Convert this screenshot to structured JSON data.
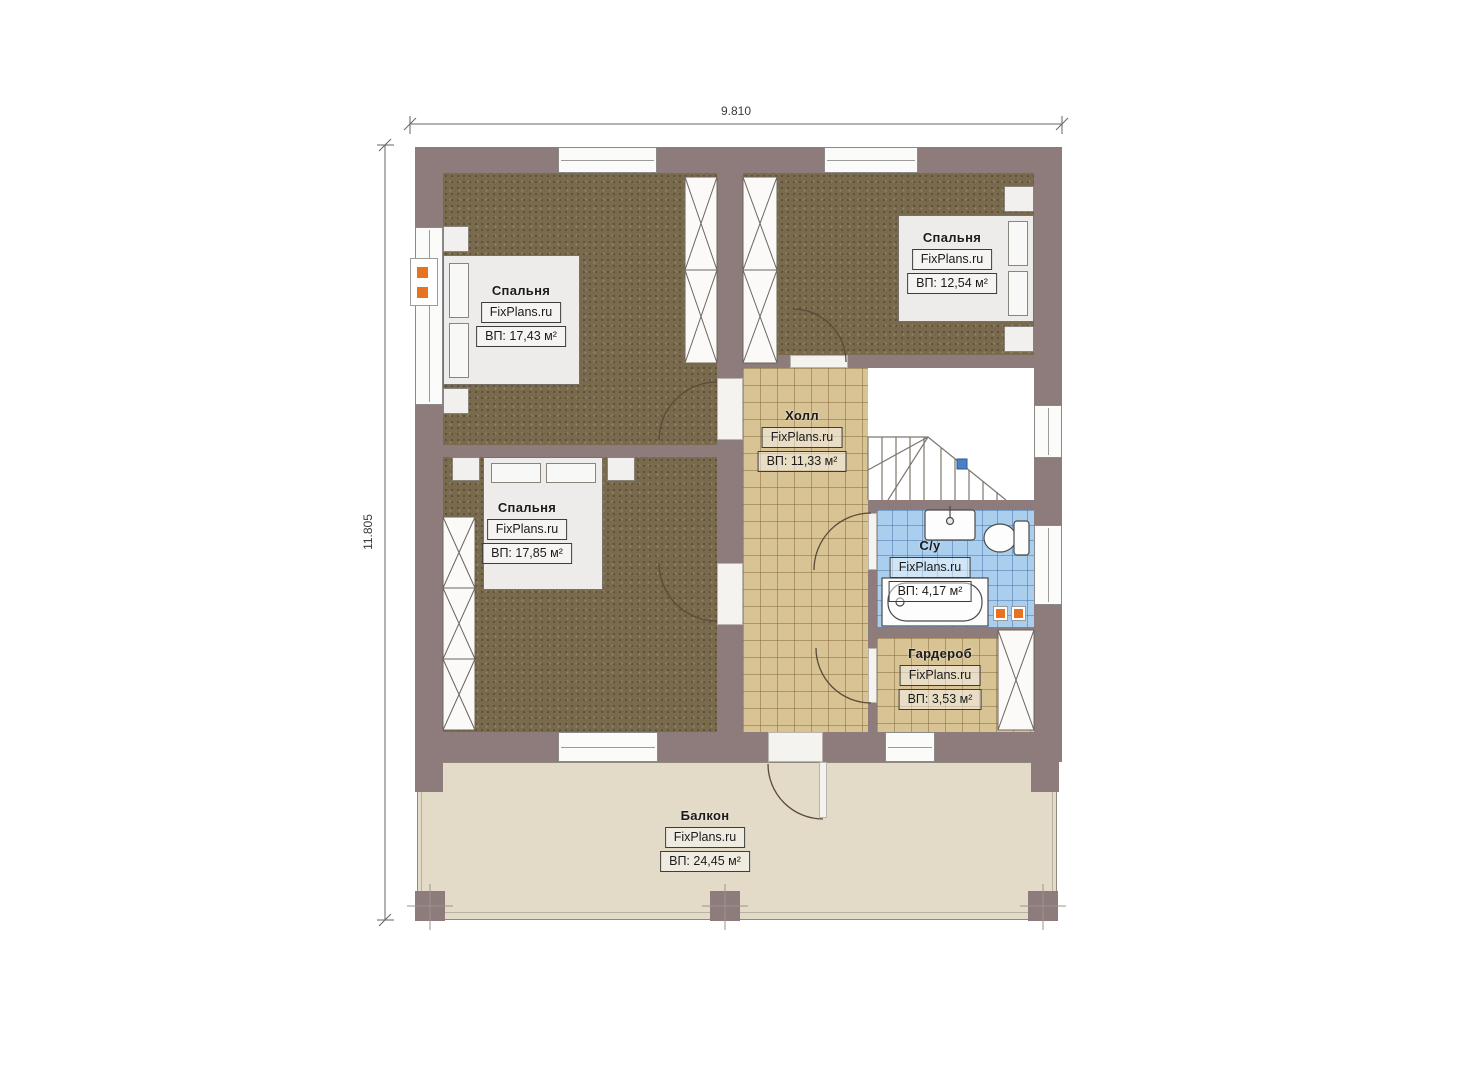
{
  "meta": {
    "drawing_type": "floor-plan",
    "language": "ru",
    "floor_description": "Second floor plan with three bedrooms, hall, bathroom, wardrobe and balcony"
  },
  "dimensions": {
    "overall_width": "9.810",
    "overall_height": "11.805"
  },
  "brand": "FixPlans.ru",
  "rooms": [
    {
      "key": "bedroom-top-left",
      "name": "Спальня",
      "brand": "FixPlans.ru",
      "area": "ВП: 17,43 м²"
    },
    {
      "key": "bedroom-top-right",
      "name": "Спальня",
      "brand": "FixPlans.ru",
      "area": "ВП: 12,54 м²"
    },
    {
      "key": "bedroom-bottom-left",
      "name": "Спальня",
      "brand": "FixPlans.ru",
      "area": "ВП: 17,85 м²"
    },
    {
      "key": "hall",
      "name": "Холл",
      "brand": "FixPlans.ru",
      "area": "ВП: 11,33 м²"
    },
    {
      "key": "bathroom",
      "name": "С/у",
      "brand": "FixPlans.ru",
      "area": "ВП: 4,17 м²"
    },
    {
      "key": "wardrobe",
      "name": "Гардероб",
      "brand": "FixPlans.ru",
      "area": "ВП: 3,53 м²"
    },
    {
      "key": "balcony",
      "name": "Балкон",
      "brand": "FixPlans.ru",
      "area": "ВП: 24,45 м²"
    }
  ],
  "colors": {
    "wall": "#8e7c7d",
    "bedroom_floor": "#796a4d",
    "tile_floor": "#d8c395",
    "bath_floor": "#aacfee",
    "balcony_floor": "#e4dac8",
    "socket": "#e8731f",
    "stair_marker": "#4a80c4"
  }
}
